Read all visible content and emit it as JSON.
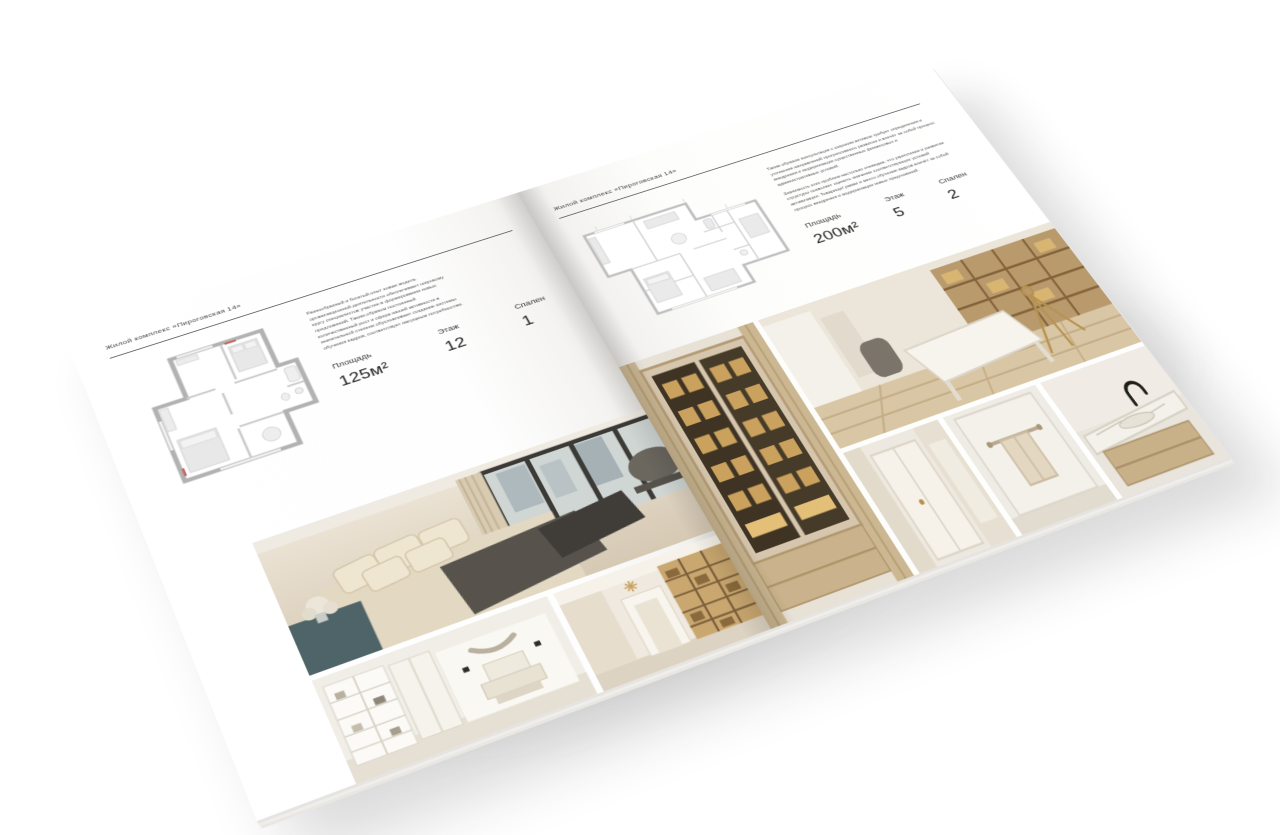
{
  "brochure": {
    "left_page": {
      "header": "Жилой комплекс «Пироговская 14»",
      "description": "Разнообразный и богатый опыт новая модель организационной деятельности обеспечивает широкому кругу специалистов участие в формировании новых предложений. Таким образом постоянный количественный рост и сфера нашей активности в значительной степени обусловливает создание системы обучения кадров, соответствует насущным потребностям.",
      "stats": [
        {
          "label": "Площадь",
          "value": "125м²"
        },
        {
          "label": "Этаж",
          "value": "12"
        },
        {
          "label": "Спален",
          "value": "1"
        }
      ]
    },
    "right_page": {
      "header": "Жилой комплекс «Пироговская 14»",
      "description_1": "Таким образом консультация с широким активом требует определения и уточнения направлений прогрессивного развития и влечёт за собой процесс внедрения и модернизации существенных финансовых и административных условий.",
      "description_2": "Значимость этих проблем настолько очевидна, что укрепление и развитие структуры позволяет оценить значение соответствующих условий активизации. Товарищи! рамки и место обучения кадров влечёт за собой процесс внедрения и модернизации новых предложений.",
      "stats": [
        {
          "label": "Площадь",
          "value": "200м²"
        },
        {
          "label": "Этаж",
          "value": "5"
        },
        {
          "label": "Спален",
          "value": "2"
        }
      ]
    },
    "colors": {
      "page": "#ffffff",
      "text": "#3b3b3b",
      "rule": "#454545",
      "plan_wall": "#b2b2b2",
      "photo_beige": "#d9cfc0",
      "photo_wood": "#b79a72",
      "photo_amber": "#c9a25d"
    }
  }
}
